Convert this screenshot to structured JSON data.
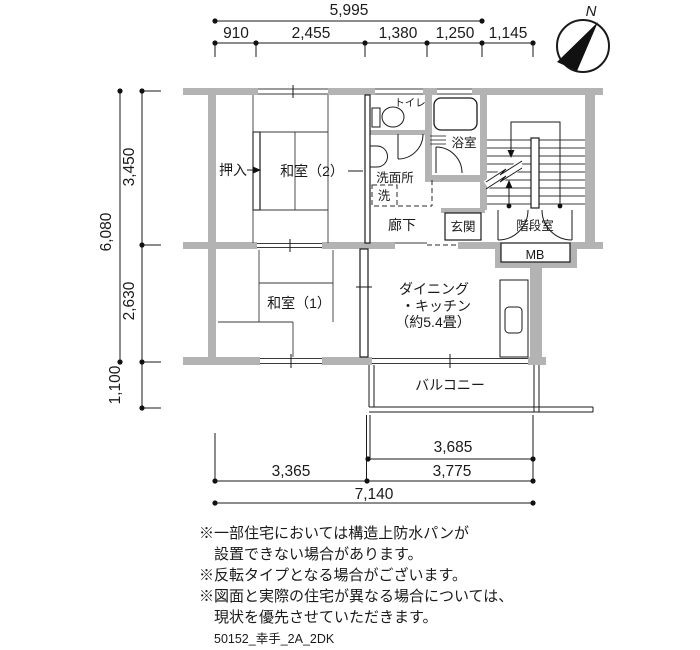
{
  "compass": {
    "north_label": "N"
  },
  "dimensions_top": {
    "total": "5,995",
    "segments": [
      "910",
      "2,455",
      "1,380",
      "1,250",
      "1,145"
    ]
  },
  "dimensions_left": {
    "total": "6,080",
    "upper": "3,450",
    "middle": "2,630",
    "lower": "1,100"
  },
  "dimensions_bottom": {
    "balcony_width": "3,685",
    "left": "3,365",
    "right": "3,775",
    "total": "7,140"
  },
  "rooms": {
    "toilet": "トイレ",
    "bath": "浴室",
    "closet": "押入",
    "japanese_room_2": "和室（2）",
    "washroom": "洗面所",
    "washing_machine": "洗",
    "hallway": "廊下",
    "entrance": "玄関",
    "stairwell": "階段室",
    "meter_box": "MB",
    "japanese_room_1": "和室（1）",
    "dining_kitchen_line1": "ダイニング",
    "dining_kitchen_line2": "・キッチン",
    "dining_kitchen_line3": "（約5.4畳）",
    "balcony": "バルコニー"
  },
  "notes": [
    "※一部住宅においては構造上防水パンが",
    "設置できない場合があります。",
    "※反転タイプとなる場合がございます。",
    "※図面と実際の住宅が異なる場合については、",
    "現状を優先させていただきます。"
  ],
  "drawing_code": "50152_幸手_2A_2DK",
  "colors": {
    "wall": "#b3b3b3",
    "line": "#1a1a1a",
    "background": "#ffffff"
  }
}
